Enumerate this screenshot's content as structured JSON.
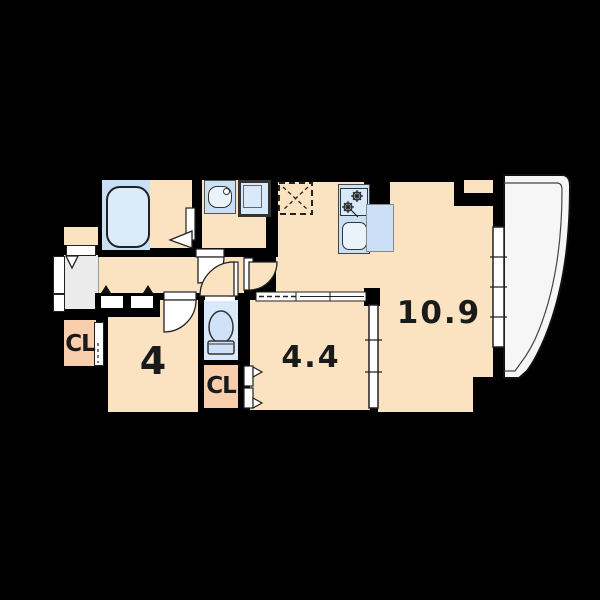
{
  "plan_title": "apartment-floor-plan",
  "rooms": {
    "living_dining": {
      "label": "10.9"
    },
    "bedroom_a": {
      "label": "4"
    },
    "bedroom_b": {
      "label": "4.4"
    },
    "closet_left": {
      "label": "CL"
    },
    "closet_middle": {
      "label": "CL"
    }
  },
  "fixtures": [
    "bathtub",
    "vanity-sink",
    "washing-machine-pan",
    "refrigerator-space",
    "gas-stove",
    "kitchen-sink",
    "toilet",
    "entrance-door",
    "balcony",
    "sliding-window",
    "sliding-partition"
  ],
  "colors": {
    "background": "#000000",
    "floor": "#FBE3C2",
    "closet": "#F8CEAC",
    "wet_floor": "#D9E9FA",
    "fixture_blue": "#C9DFF4",
    "entry_grey": "#EBEBEB",
    "balcony_white": "#F6F6F6",
    "outline": "#1A1A1A"
  }
}
